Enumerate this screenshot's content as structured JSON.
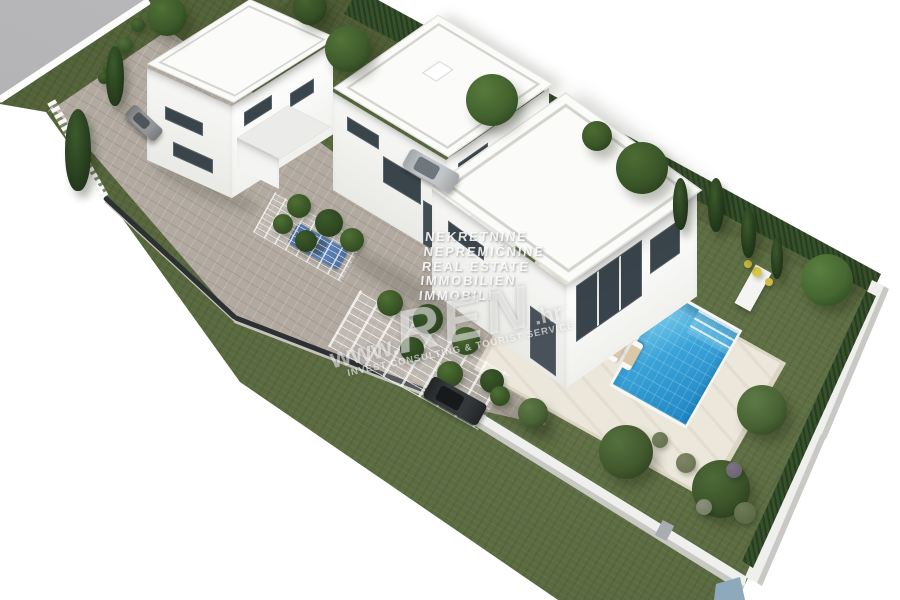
{
  "watermark": {
    "languages": [
      "NEKRETNINE",
      "NEPREMIČNINE",
      "REAL ESTATE",
      "IMMOBILIEN",
      "IMMOBILI"
    ],
    "brand_prefix": "www.",
    "brand_name": "REN",
    "brand_suffix": ".hr",
    "tagline": "INVEST CONSULTING & TOURIST SERVICE"
  },
  "palette": {
    "background": "#ffffff",
    "lawn_green": "#5a6b3d",
    "road_gray": "#b5b5b7",
    "pavement_beige": "#b2aaa0",
    "building_white": "#f4f4f2",
    "pool_blue": "#2e9ad3",
    "deck_travertine": "#ece7db",
    "hedge_green": "#35502b",
    "cypress_green": "#22371a",
    "car_blue": "#2f5fa3",
    "car_dark": "#34383b",
    "car_silver": "#c2c5c8",
    "car_gray": "#939598",
    "watermark_white": "#ffffff"
  }
}
